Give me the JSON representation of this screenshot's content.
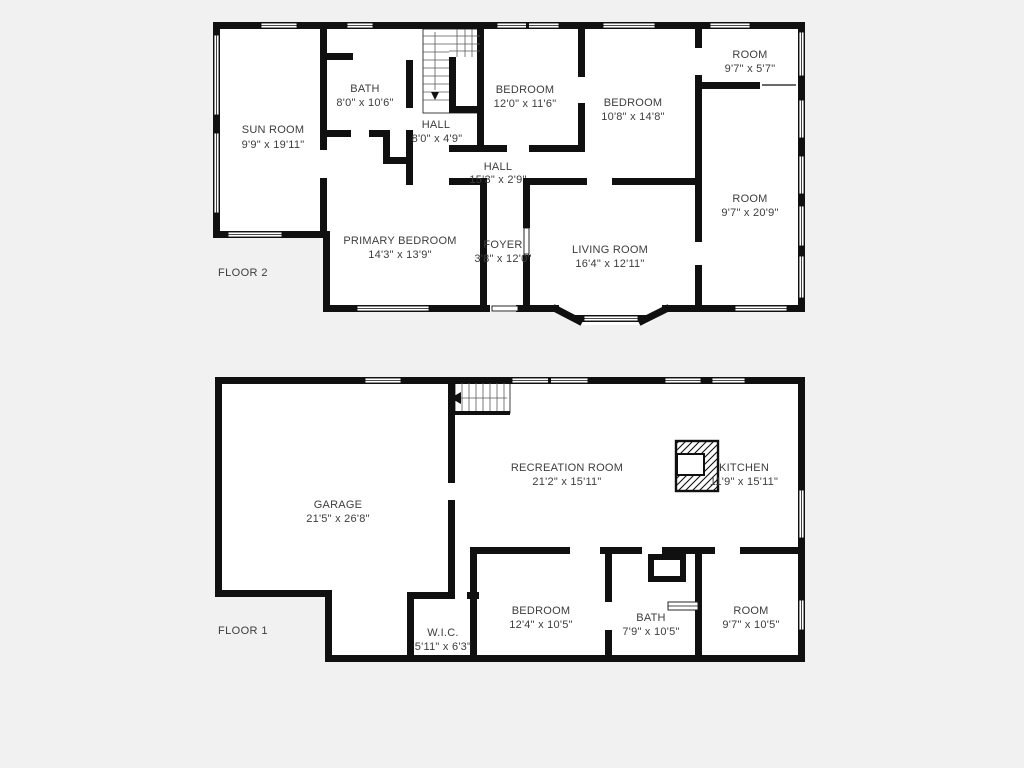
{
  "plan": {
    "background": "#f1f1f1",
    "wall_color": "#101010",
    "room_fill": "#ffffff",
    "label_color": "#3d3d3d"
  },
  "floors": [
    {
      "label": "FLOOR 2",
      "rooms": [
        {
          "name": "SUN ROOM",
          "dims": "9'9\" x 19'11\""
        },
        {
          "name": "BATH",
          "dims": "8'0\" x 10'6\""
        },
        {
          "name": "HALL",
          "dims": "8'0\" x 4'9\""
        },
        {
          "name": "BEDROOM",
          "dims": "12'0\" x 11'6\""
        },
        {
          "name": "BEDROOM",
          "dims": "10'8\" x 14'8\""
        },
        {
          "name": "ROOM",
          "dims": "9'7\" x 5'7\""
        },
        {
          "name": "ROOM",
          "dims": "9'7\" x 20'9\""
        },
        {
          "name": "HALL",
          "dims": "15'3\" x 2'9\""
        },
        {
          "name": "PRIMARY BEDROOM",
          "dims": "14'3\" x 13'9\""
        },
        {
          "name": "FOYER",
          "dims": "3'8\" x 12'0\""
        },
        {
          "name": "LIVING ROOM",
          "dims": "16'4\" x 12'11\""
        }
      ]
    },
    {
      "label": "FLOOR 1",
      "rooms": [
        {
          "name": "GARAGE",
          "dims": "21'5\" x 26'8\""
        },
        {
          "name": "RECREATION ROOM",
          "dims": "21'2\" x 15'11\""
        },
        {
          "name": "KITCHEN",
          "dims": "11'9\" x 15'11\""
        },
        {
          "name": "W.I.C.",
          "dims": "5'11\" x 6'3\""
        },
        {
          "name": "BEDROOM",
          "dims": "12'4\" x 10'5\""
        },
        {
          "name": "BATH",
          "dims": "7'9\" x 10'5\""
        },
        {
          "name": "ROOM",
          "dims": "9'7\" x 10'5\""
        }
      ]
    }
  ]
}
